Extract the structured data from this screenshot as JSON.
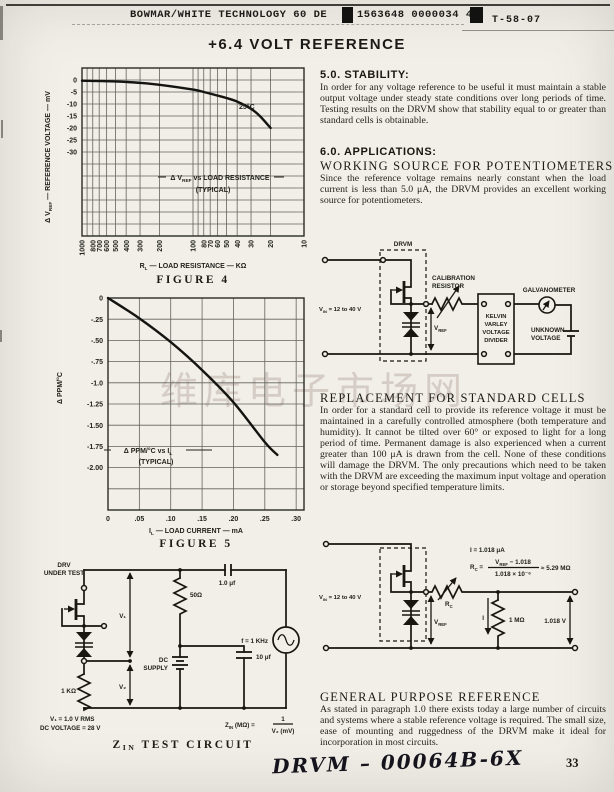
{
  "page": {
    "header": {
      "company": "BOWMAR/WHITE TECHNOLOGY 60  DE",
      "code_number": "1563648 0000034 4",
      "doc_ref": "T-58-07"
    },
    "title": "+6.4 VOLT REFERENCE",
    "page_number": "33",
    "handwritten_note": "DRVM – 00064B-6X",
    "watermark": "维库电子市场网"
  },
  "sections": {
    "stability": {
      "heading": "5.0. STABILITY:",
      "body": "In order for any voltage reference to be useful it must maintain a stable output voltage under steady state conditions over long periods of time. Testing results on the DRVM show that stability equal to or greater than standard cells is obtainable."
    },
    "applications": {
      "heading": "6.0. APPLICATIONS:",
      "subheading": "WORKING SOURCE FOR POTENTIOMETERS",
      "body": "Since the reference voltage remains nearly constant when the load current is less than 5.0 μA, the DRVM provides an excellent working source for potentiometers."
    },
    "replacement": {
      "heading": "REPLACEMENT FOR STANDARD CELLS",
      "body": "In order for a standard cell to provide its reference voltage it must be maintained in a carefully controlled atmosphere (both temperature and humidity). It cannot be tilted over 60° or exposed to light for a long period of time. Permanent damage is also experienced when a current greater than 100 μA is drawn from the cell. None of these conditions will damage the DRVM. The only precautions which need to be taken with the DRVM are exceeding the maximum input voltage and operation or storage beyond specified temperature limits."
    },
    "general": {
      "heading": "GENERAL PURPOSE REFERENCE",
      "body": "As stated in paragraph 1.0 there exists today a large number of circuits and systems where a stable reference voltage is required. The small size, ease of mounting and ruggedness of the DRVM make it ideal for incorporation in most circuits."
    }
  },
  "circuits": {
    "working": {
      "drvm": "DRVM",
      "vin": "V_{IN} = 12 to 40 V",
      "vref": "V_{REF}",
      "cal_l1": "CALIBRATION",
      "cal_l2": "RESISTOR",
      "kelvin": [
        "KELVIN",
        "VARLEY",
        "VOLTAGE",
        "DIVIDER"
      ],
      "galvanometer": "GALVANOMETER",
      "unknown_l1": "UNKNOWN",
      "unknown_l2": "VOLTAGE"
    },
    "general_ref": {
      "vin": "V_{IN} = 12 to 40 V",
      "vref": "V_{REF}",
      "rc": "R_{C}",
      "eq_i": "I  =  1.018 μA",
      "eq_rc_lhs": "R_{C} =",
      "eq_rc_num": "V_{REF} − 1.018",
      "eq_rc_den": "1.018 × 10⁻⁶",
      "eq_rc_rhs": "≈ 5.29 MΩ",
      "i": "I",
      "r_load": "1 MΩ",
      "v_out": "1.018 V"
    },
    "zin": {
      "dut_l1": "DRV",
      "dut_l2": "UNDER TEST",
      "r1": "1 KΩ",
      "v1": "V₁",
      "v2": "V₂",
      "r2": "50Ω",
      "dc_l1": "DC",
      "dc_l2": "SUPPLY",
      "c1": "1.0 μf",
      "freq": "f = 1 KHz",
      "c2": "10 μf",
      "note1": "V₁ = 1.0 V RMS",
      "note2": "DC VOLTAGE = 28 V",
      "formula_lhs": "Z_{IN} (MΩ) =",
      "formula_num": "1",
      "formula_den": "V₂ (mV)",
      "caption": "Z_{IN} TEST CIRCUIT"
    }
  },
  "chart_data": [
    {
      "id": "figure4",
      "type": "line",
      "title": "FIGURE 4",
      "xlabel": "R_{L} — LOAD RESISTANCE — KΩ",
      "ylabel": "Δ V_{REF} — REFERENCE VOLTAGE — mV",
      "annotation": [
        "Δ V_{REF} vs LOAD RESISTANCE",
        "(TYPICAL)"
      ],
      "curve_label": "25°C",
      "x_scale": "log reversed (1000 → 10)",
      "x_grid": [
        1000,
        900,
        800,
        700,
        600,
        500,
        400,
        300,
        200,
        100,
        90,
        80,
        70,
        60,
        50,
        40,
        30,
        20,
        10
      ],
      "x_ticks": [
        1000,
        800,
        700,
        600,
        500,
        400,
        300,
        200,
        100,
        80,
        70,
        60,
        50,
        40,
        30,
        20,
        10
      ],
      "x_tick_labels": [
        "1000",
        "800",
        "700",
        "600",
        "500",
        "400",
        "300",
        "200",
        "100",
        "80",
        "70",
        "60",
        "50",
        "40",
        "30",
        "20",
        "10"
      ],
      "y_ticks": [
        0,
        -5,
        -10,
        -15,
        -20,
        -25,
        -30
      ],
      "y_tick_labels": [
        "0",
        "-5",
        "-10",
        "-15",
        "-20",
        "-25",
        "-30"
      ],
      "ylim": [
        5,
        -65
      ],
      "grid": true,
      "x": [
        1000,
        500,
        300,
        200,
        100,
        80,
        60,
        50,
        40,
        30,
        25,
        20
      ],
      "y": [
        -0.3,
        -0.6,
        -1.2,
        -2.0,
        -4.0,
        -5.0,
        -6.5,
        -7.5,
        -9.0,
        -12.0,
        -15.0,
        -20.0
      ]
    },
    {
      "id": "figure5",
      "type": "line",
      "title": "FIGURE 5",
      "xlabel": "I_{L} — LOAD CURRENT — mA",
      "ylabel": "Δ PPM/°C",
      "annotation": [
        "Δ PPM/°C vs I_{L}",
        "(TYPICAL)"
      ],
      "xlim": [
        0,
        0.3125
      ],
      "ylim": [
        0,
        -2.5
      ],
      "grid": true,
      "x_ticks": [
        0,
        0.05,
        0.1,
        0.15,
        0.2,
        0.25,
        0.3
      ],
      "x_tick_labels": [
        "0",
        ".05",
        ".10",
        ".15",
        ".20",
        ".25",
        ".30"
      ],
      "y_ticks": [
        0,
        -0.25,
        -0.5,
        -0.75,
        -1.0,
        -1.25,
        -1.5,
        -1.75,
        -2.0
      ],
      "y_tick_labels": [
        "0",
        "-.25",
        "-.50",
        "-.75",
        "-1.0",
        "-1.25",
        "-1.50",
        "-1.75",
        "-2.00"
      ],
      "x": [
        0,
        0.05,
        0.1,
        0.15,
        0.2,
        0.25,
        0.27
      ],
      "y": [
        0,
        -0.24,
        -0.52,
        -0.85,
        -1.23,
        -1.7,
        -1.85
      ]
    }
  ]
}
